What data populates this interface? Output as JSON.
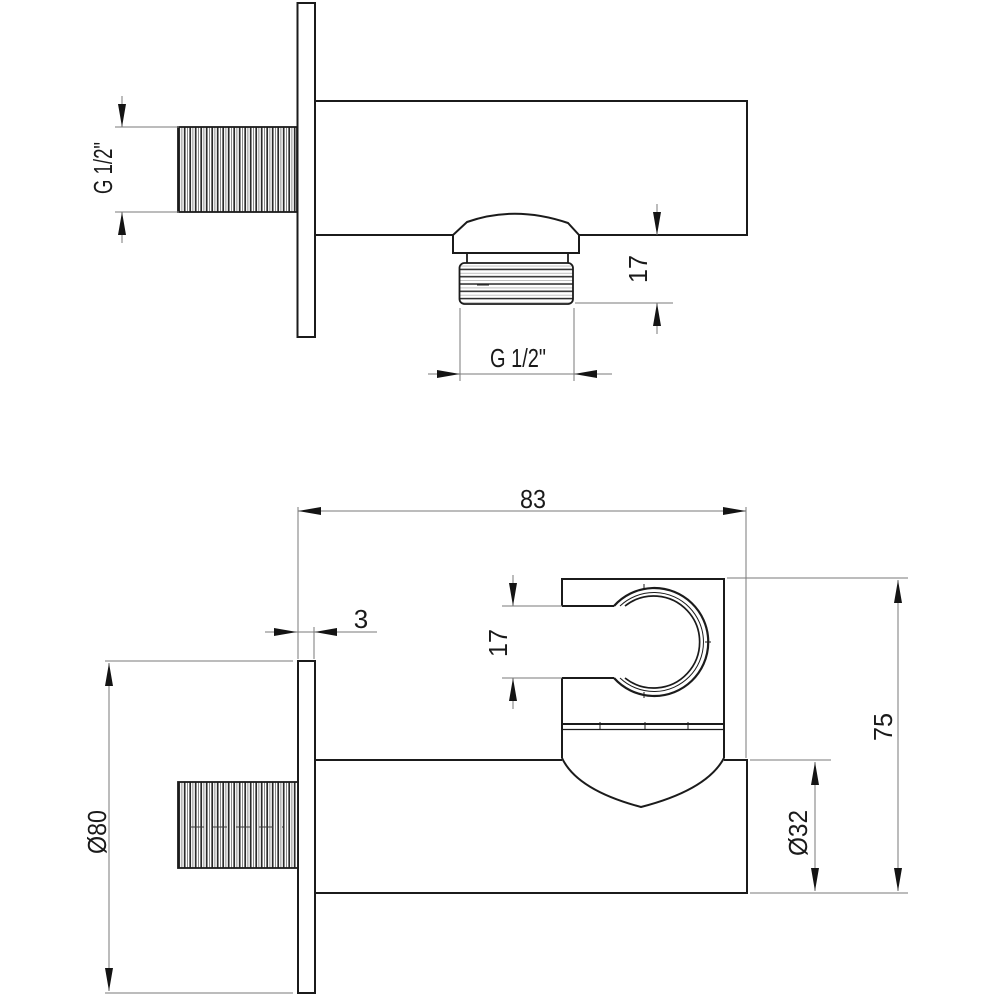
{
  "drawing": {
    "type": "technical-dimension-drawing",
    "subject": "wall-mounted shower elbow with hand-shower holder",
    "colors": {
      "outline": "#1b1b1b",
      "dimension_line": "#7a7a7a",
      "background": "#ffffff"
    },
    "views": {
      "top_view": {
        "name": "side view",
        "labels": {
          "inlet_thread": "G 1/2\"",
          "outlet_length": "17",
          "outlet_thread": "G 1/2\""
        }
      },
      "front_view": {
        "name": "front view",
        "labels": {
          "width": "83",
          "plate_thickness": "3",
          "holder_slot": "17",
          "height": "75",
          "body_diameter": "Ø32",
          "plate_diameter": "Ø80"
        }
      }
    }
  }
}
